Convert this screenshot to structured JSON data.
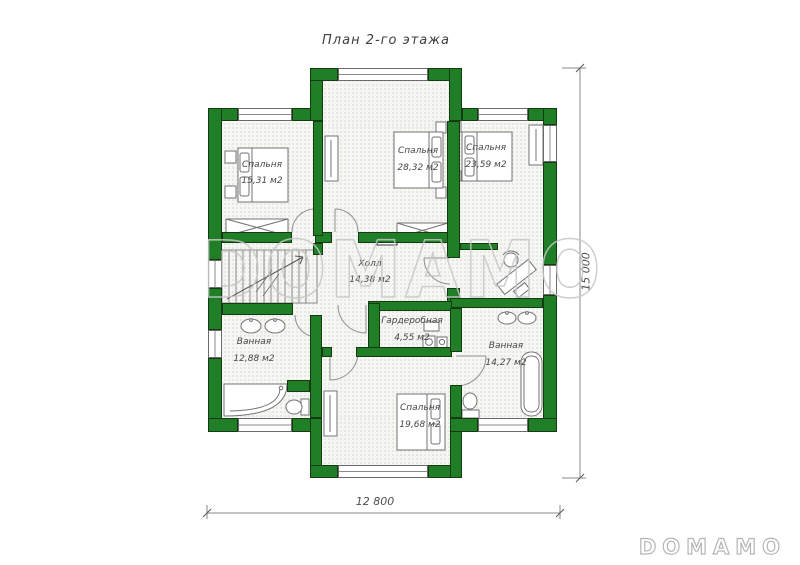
{
  "title": "План 2-го этажа",
  "watermarks": {
    "center": "DOMAMO",
    "corner": "DOMAMO"
  },
  "dimensions": {
    "bottom": "12 800",
    "right": "15 000"
  },
  "rooms": [
    {
      "id": "bedroom-top-left",
      "name": "Спальня",
      "area": "15,31 м2"
    },
    {
      "id": "bedroom-top-middle",
      "name": "Спальня",
      "area": "28,32 м2"
    },
    {
      "id": "bedroom-top-right",
      "name": "Спальня",
      "area": "23,59 м2"
    },
    {
      "id": "hall",
      "name": "Холл",
      "area": "14,38 м2"
    },
    {
      "id": "wardrobe-room",
      "name": "Гардеробная",
      "area": "4,55 м2"
    },
    {
      "id": "bathroom-left",
      "name": "Ванная",
      "area": "12,88 м2"
    },
    {
      "id": "bathroom-right",
      "name": "Ванная",
      "area": "14,27 м2"
    },
    {
      "id": "bedroom-bottom",
      "name": "Спальня",
      "area": "19,68 м2"
    }
  ],
  "icons": {
    "bed-icon": "rectangle with pillows",
    "wardrobe-icon": "crossed rectangle",
    "stairs-icon": "stepped lines with arrow",
    "bathtub-icon": "rounded rectangle",
    "corner-bathtub-icon": "quarter-round shape",
    "sink-icon": "oval basin",
    "toilet-icon": "oval with tank",
    "washer-icon": "square with drum circle",
    "desk-chair-icon": "rotated desk with chair",
    "door-arc-icon": "quarter-circle swing",
    "fireplace-icon": "wall box with dark square"
  },
  "colors": {
    "wall": "#1f7e26",
    "wall_outline": "#143a12",
    "floor": "#f6f7f3",
    "watermark": "#c7c7c7"
  }
}
